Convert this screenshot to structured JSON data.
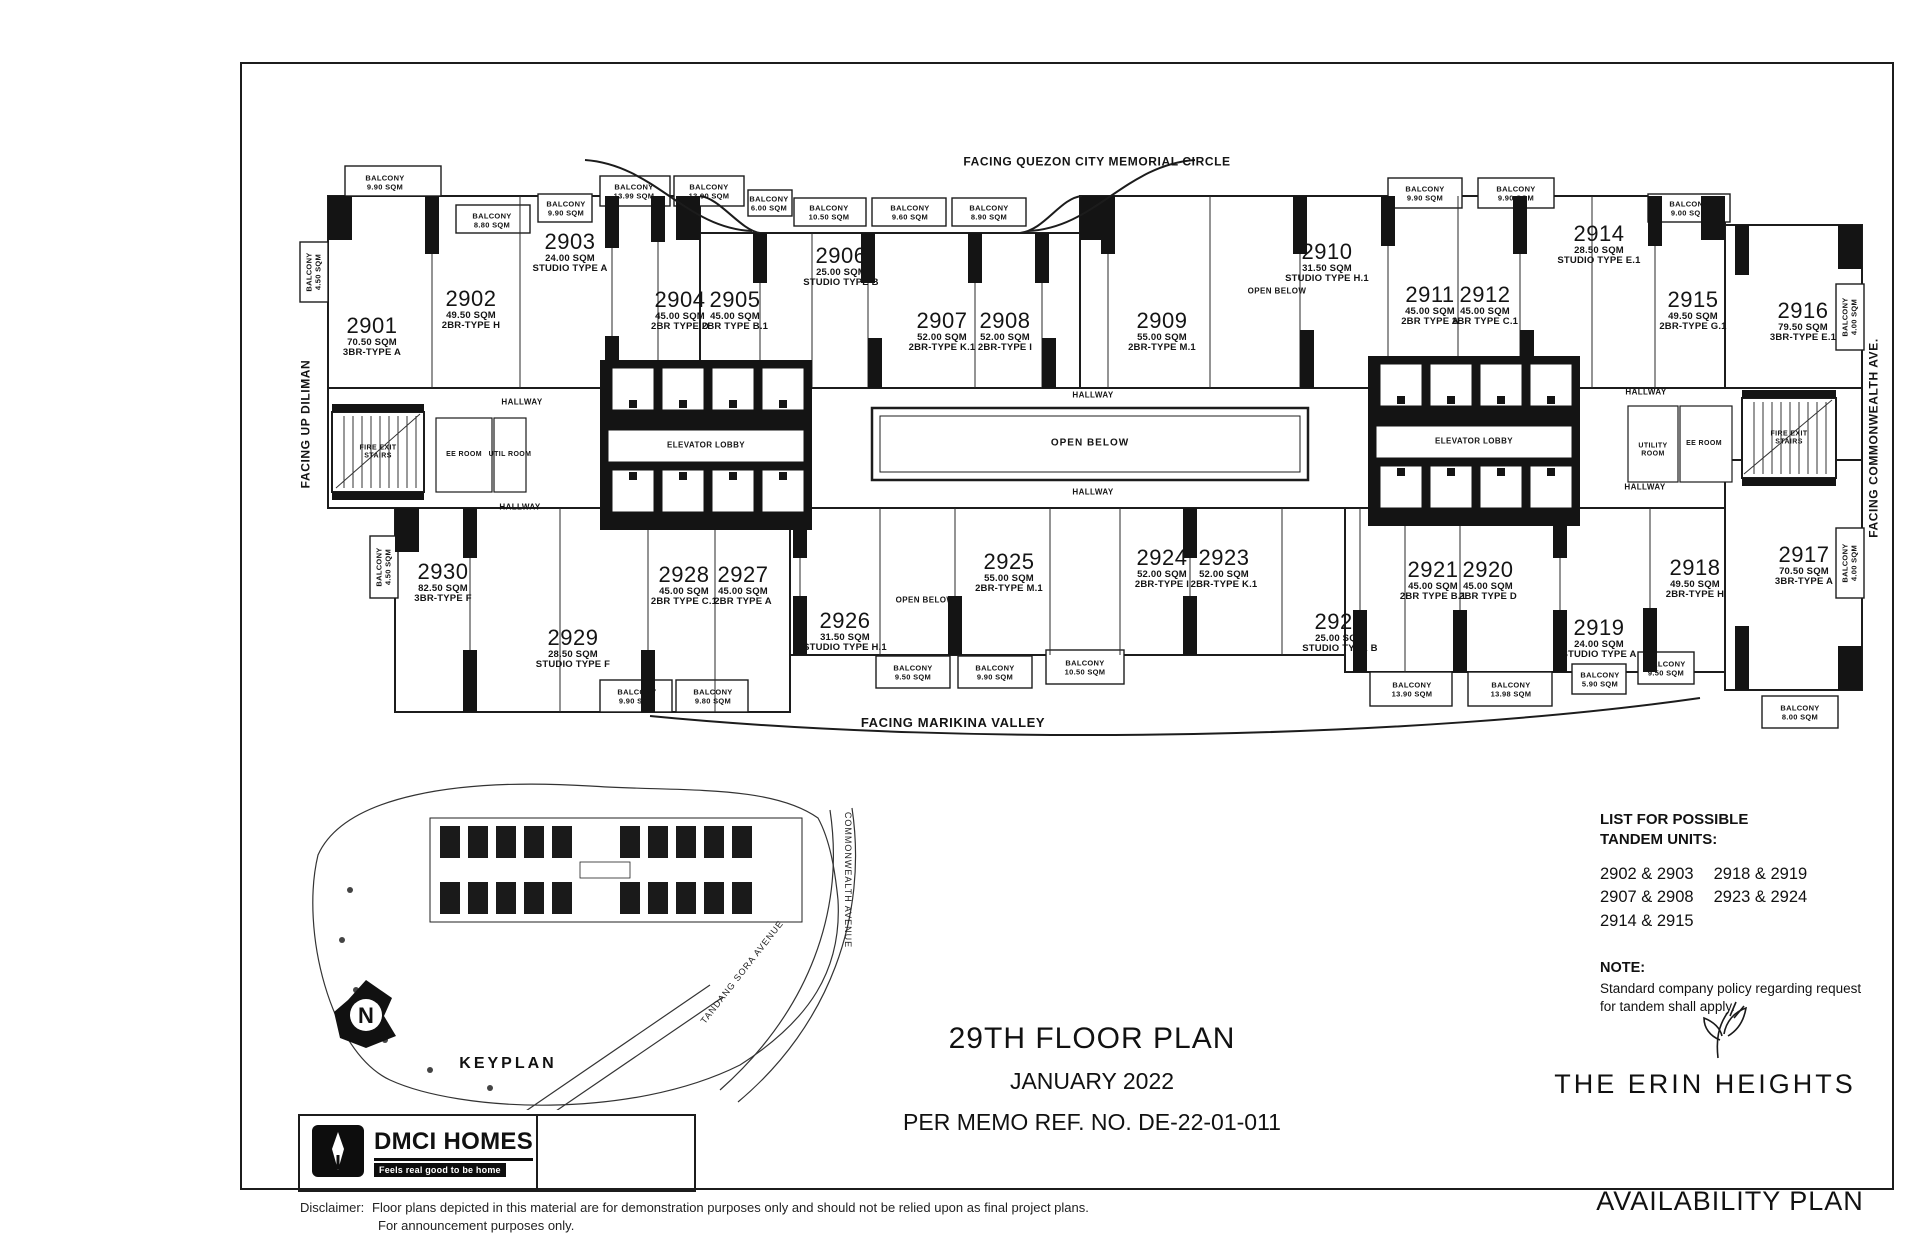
{
  "sheet": {
    "facing_top": "FACING QUEZON CITY MEMORIAL CIRCLE",
    "facing_bottom": "FACING MARIKINA VALLEY",
    "facing_left": "FACING UP DILIMAN",
    "facing_right": "FACING COMMONWEALTH AVE.",
    "availability_plan": "AVAILABILITY PLAN"
  },
  "units": [
    {
      "no": "2901",
      "sqm": "70.50 SQM",
      "type": "3BR-TYPE A"
    },
    {
      "no": "2902",
      "sqm": "49.50 SQM",
      "type": "2BR-TYPE H"
    },
    {
      "no": "2903",
      "sqm": "24.00 SQM",
      "type": "STUDIO TYPE A"
    },
    {
      "no": "2904",
      "sqm": "45.00 SQM",
      "type": "2BR TYPE D"
    },
    {
      "no": "2905",
      "sqm": "45.00 SQM",
      "type": "2BR TYPE B.1"
    },
    {
      "no": "2906",
      "sqm": "25.00 SQM",
      "type": "STUDIO TYPE B"
    },
    {
      "no": "2907",
      "sqm": "52.00 SQM",
      "type": "2BR-TYPE K.1"
    },
    {
      "no": "2908",
      "sqm": "52.00 SQM",
      "type": "2BR-TYPE I"
    },
    {
      "no": "2909",
      "sqm": "55.00 SQM",
      "type": "2BR-TYPE M.1"
    },
    {
      "no": "2910",
      "sqm": "31.50 SQM",
      "type": "STUDIO TYPE H.1"
    },
    {
      "no": "2911",
      "sqm": "45.00 SQM",
      "type": "2BR TYPE A"
    },
    {
      "no": "2912",
      "sqm": "45.00 SQM",
      "type": "2BR TYPE C.1"
    },
    {
      "no": "2914",
      "sqm": "28.50 SQM",
      "type": "STUDIO TYPE E.1"
    },
    {
      "no": "2915",
      "sqm": "49.50 SQM",
      "type": "2BR-TYPE G.1"
    },
    {
      "no": "2916",
      "sqm": "79.50 SQM",
      "type": "3BR-TYPE E.1"
    },
    {
      "no": "2917",
      "sqm": "70.50 SQM",
      "type": "3BR-TYPE A"
    },
    {
      "no": "2918",
      "sqm": "49.50 SQM",
      "type": "2BR-TYPE H"
    },
    {
      "no": "2919",
      "sqm": "24.00 SQM",
      "type": "STUDIO TYPE A"
    },
    {
      "no": "2920",
      "sqm": "45.00 SQM",
      "type": "2BR TYPE D"
    },
    {
      "no": "2921",
      "sqm": "45.00 SQM",
      "type": "2BR TYPE B.1"
    },
    {
      "no": "2922",
      "sqm": "25.00 SQM",
      "type": "STUDIO TYPE B"
    },
    {
      "no": "2923",
      "sqm": "52.00 SQM",
      "type": "2BR-TYPE K.1"
    },
    {
      "no": "2924",
      "sqm": "52.00 SQM",
      "type": "2BR-TYPE I"
    },
    {
      "no": "2925",
      "sqm": "55.00 SQM",
      "type": "2BR-TYPE M.1"
    },
    {
      "no": "2926",
      "sqm": "31.50 SQM",
      "type": "STUDIO TYPE H.1"
    },
    {
      "no": "2927",
      "sqm": "45.00 SQM",
      "type": "2BR TYPE A"
    },
    {
      "no": "2928",
      "sqm": "45.00 SQM",
      "type": "2BR TYPE C.1"
    },
    {
      "no": "2929",
      "sqm": "28.50 SQM",
      "type": "STUDIO TYPE F"
    },
    {
      "no": "2930",
      "sqm": "82.50 SQM",
      "type": "3BR-TYPE F"
    }
  ],
  "room_labels": {
    "hallway": "HALLWAY",
    "elevator_lobby": "ELEVATOR LOBBY",
    "open_below": "OPEN BELOW",
    "fire_exit_stairs": "FIRE EXIT STAIRS",
    "ee_room": "EE ROOM",
    "util_room": "UTIL ROOM",
    "utility_room": "UTILITY ROOM"
  },
  "balcony_label": "BALCONY",
  "balconies": [
    "9.90 SQM",
    "8.80 SQM",
    "9.90 SQM",
    "13.99 SQM",
    "13.90 SQM",
    "6.00 SQM",
    "10.50 SQM",
    "9.60 SQM",
    "8.90 SQM",
    "9.90 SQM",
    "9.90 SQM",
    "9.00 SQM",
    "9.90 SQM",
    "9.80 SQM",
    "9.50 SQM",
    "9.90 SQM",
    "10.50 SQM",
    "13.90 SQM",
    "13.98 SQM",
    "5.90 SQM",
    "9.50 SQM",
    "8.00 SQM",
    "4.50 SQM",
    "4.00 SQM",
    "4.00 SQM",
    "4.50 SQM"
  ],
  "tandem": {
    "title_line1": "LIST FOR POSSIBLE",
    "title_line2": "TANDEM UNITS:",
    "pairs_col1": [
      "2902 & 2903",
      "2907 & 2908",
      "2914 & 2915"
    ],
    "pairs_col2": [
      "2918 & 2919",
      "2923 & 2924"
    ],
    "note_title": "NOTE:",
    "note_body": "Standard company policy regarding request for tandem shall apply."
  },
  "title_block": {
    "line1": "29TH FLOOR PLAN",
    "line2": "JANUARY 2022",
    "line3": "PER MEMO REF. NO. DE-22-01-011"
  },
  "brand": {
    "name": "THE ERIN HEIGHTS"
  },
  "dmci": {
    "name": "DMCI HOMES",
    "tagline": "Feels real good to be home"
  },
  "keyplan": {
    "label": "KEYPLAN",
    "north_letter": "N",
    "road_commonwealth": "COMMONWEALTH AVENUE",
    "road_tandang_sora": "TANDANG SORA AVENUE"
  },
  "disclaimer": {
    "label": "Disclaimer:",
    "line1": "Floor plans depicted in this material are for demonstration purposes only and should not be relied upon as final project plans.",
    "line2": "For announcement purposes only."
  }
}
